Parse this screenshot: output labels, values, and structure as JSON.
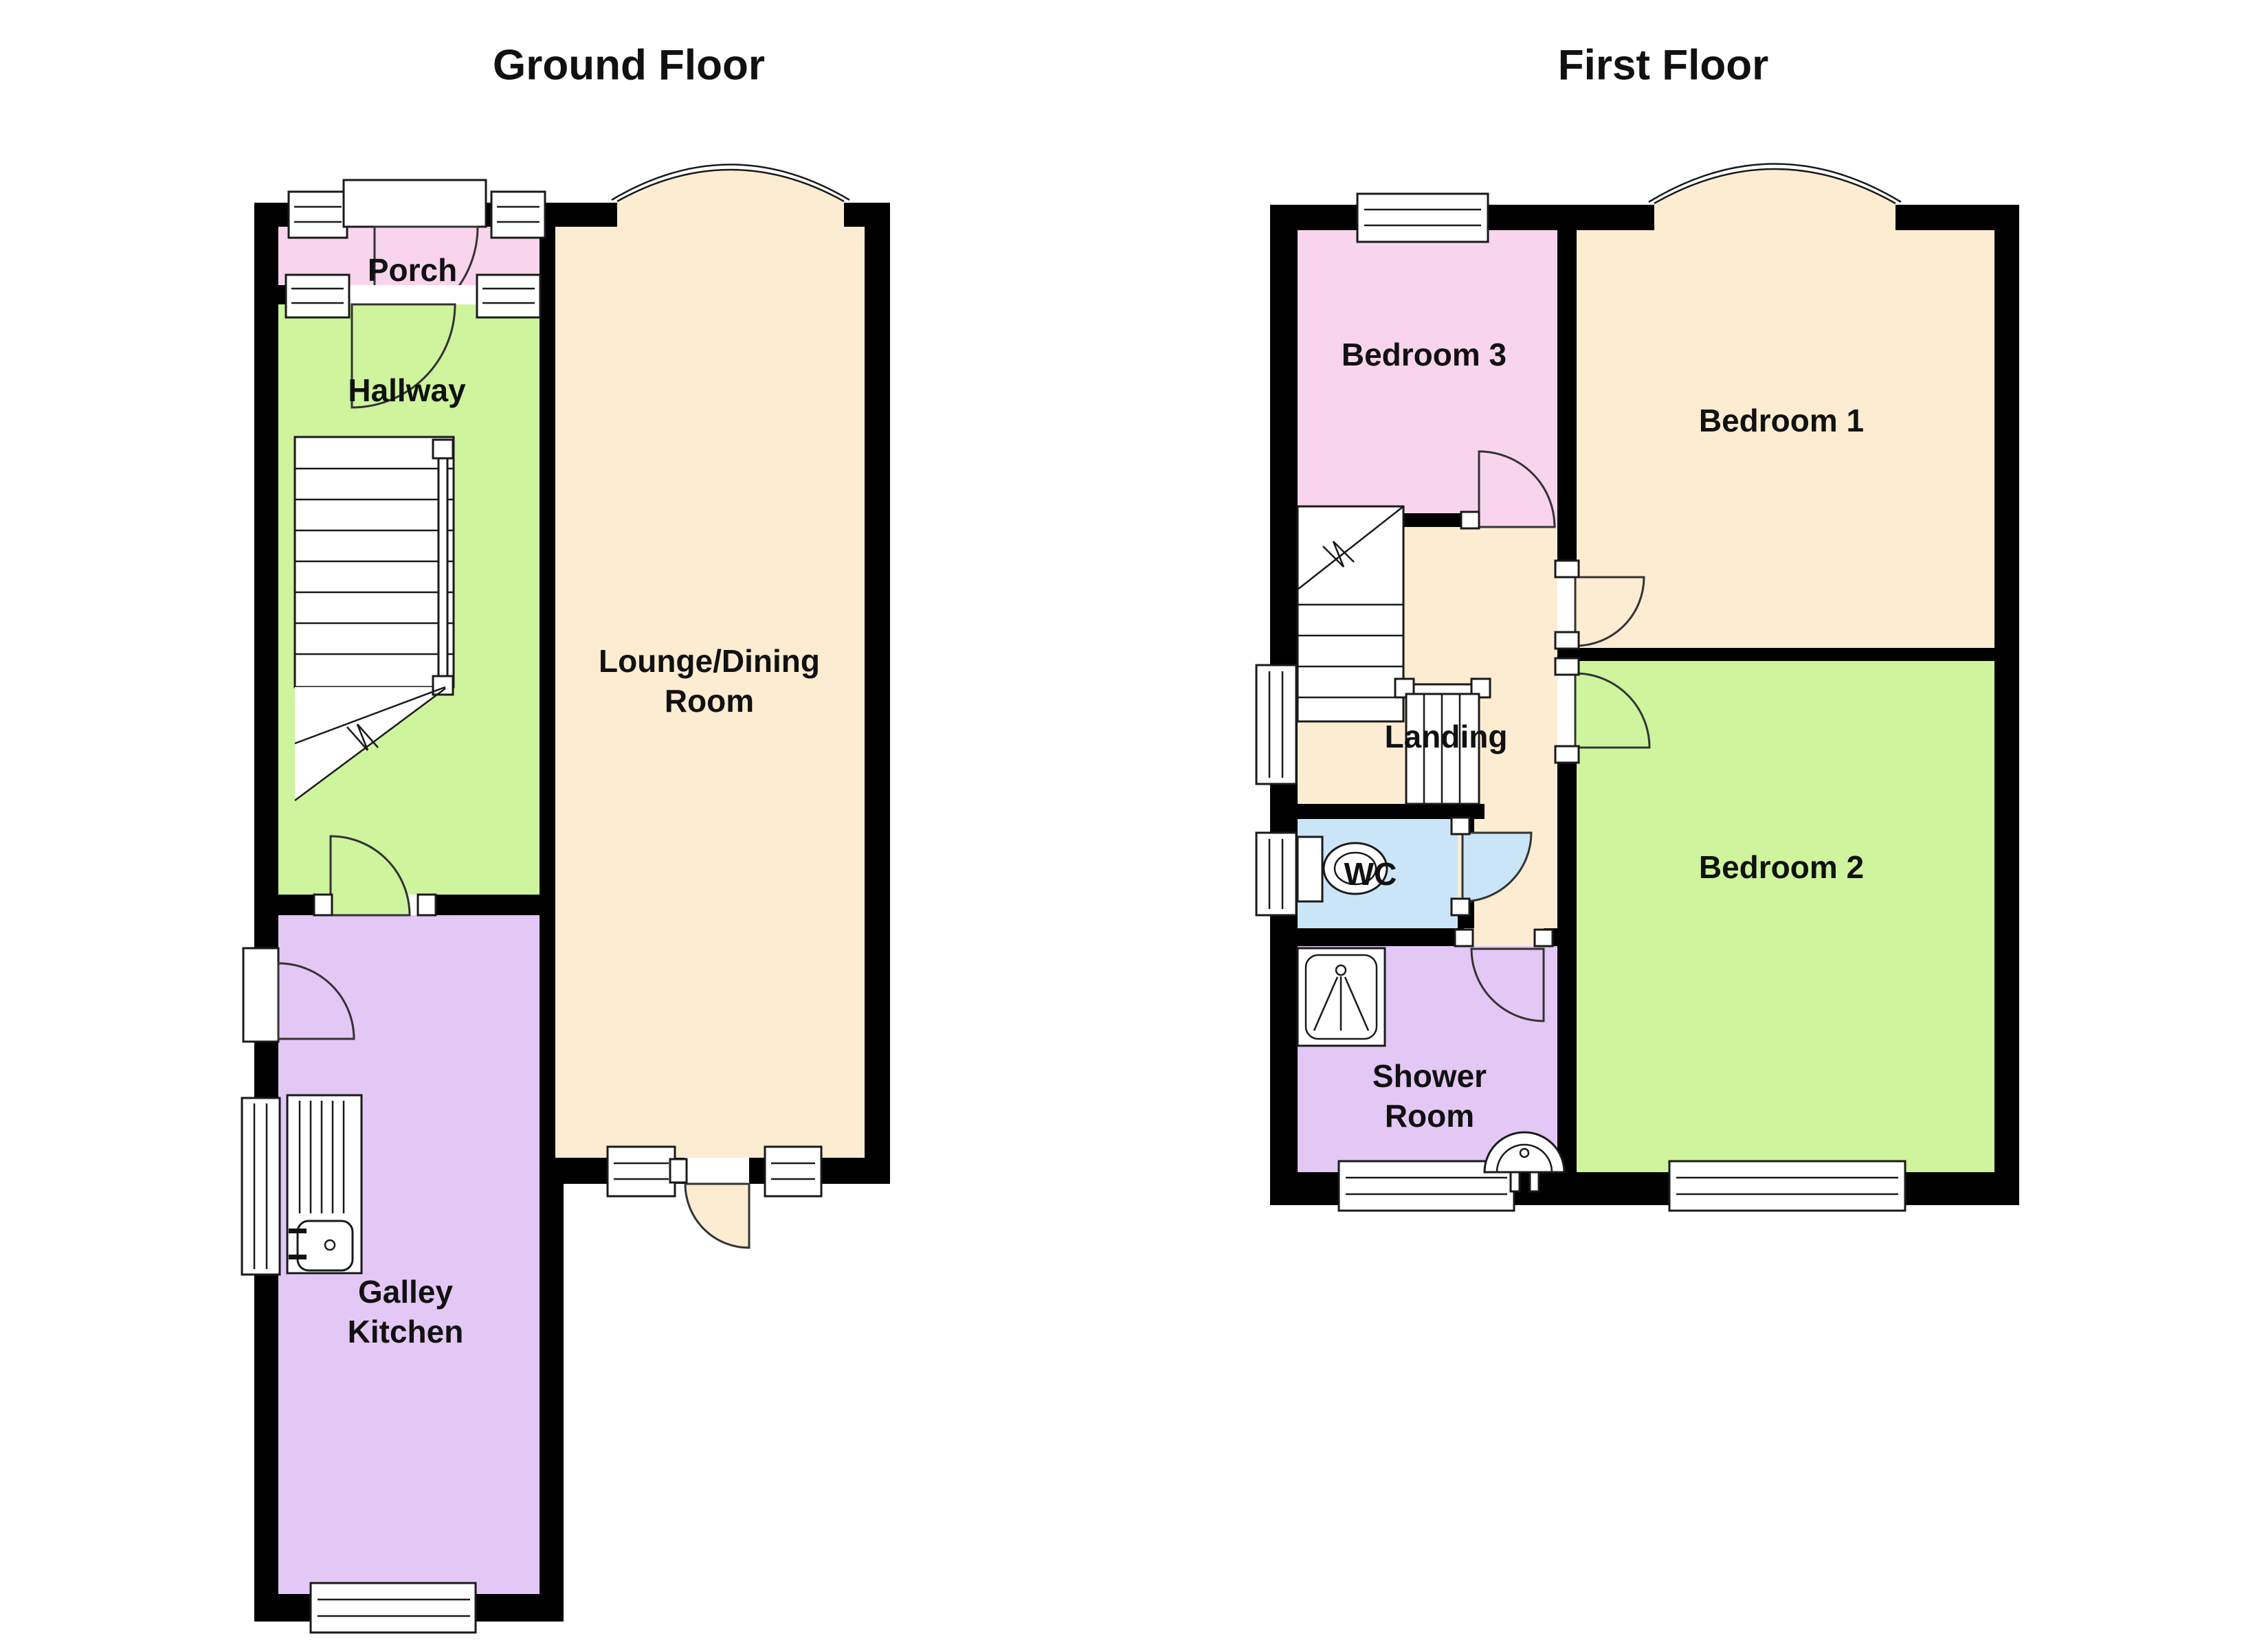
{
  "titles": {
    "ground": "Ground Floor",
    "first": "First Floor"
  },
  "rooms": {
    "porch": "Porch",
    "hallway": "Hallway",
    "lounge_line1": "Lounge/Dining",
    "lounge_line2": "Room",
    "kitchen_line1": "Galley",
    "kitchen_line2": "Kitchen",
    "bedroom3": "Bedroom 3",
    "bedroom1": "Bedroom 1",
    "landing": "Landing",
    "wc": "WC",
    "shower_line1": "Shower",
    "shower_line2": "Room",
    "bedroom2": "Bedroom 2"
  },
  "colors": {
    "wall": "#000000",
    "porch": "#F8D5EC",
    "hallway": "#CEF49D",
    "lounge": "#FCECD2",
    "kitchen": "#E3C8F6",
    "bedroom3": "#F8D5EC",
    "bedroom1": "#FCECD2",
    "landing": "#FCECD2",
    "wc": "#CBE5F8",
    "shower": "#E3C8F6",
    "bedroom2": "#CEF49D",
    "background": "#FFFFFF"
  }
}
